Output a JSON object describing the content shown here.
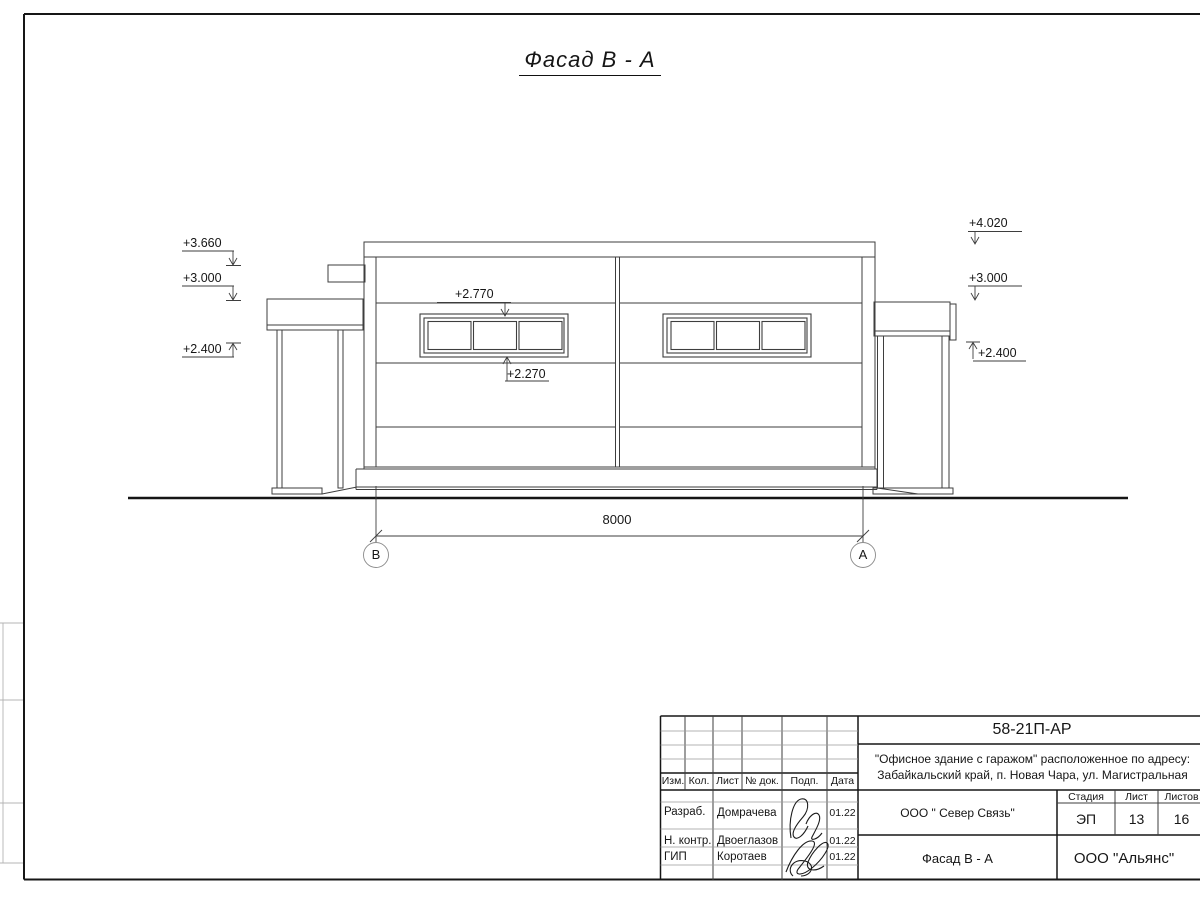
{
  "sheet": {
    "view_title": "Фасад В - А"
  },
  "drawing": {
    "marks_left": [
      "+3.660",
      "+3.000",
      "+2.400"
    ],
    "mark_window_top": "+2.770",
    "mark_window_bottom": "+2.270",
    "marks_right": [
      "+4.020",
      "+3.000",
      "+2.400"
    ],
    "dimension_total": "8000",
    "axis_left": "В",
    "axis_right": "А"
  },
  "title_block": {
    "doc_number": "58-21П-АР",
    "project_line1": "\"Офисное здание с гаражом\" расположенное по адресу:",
    "project_line2": "Забайкальский край, п. Новая Чара, ул. Магистральная",
    "col_izm": "Изм.",
    "col_kol": "Кол.",
    "col_list": "Лист",
    "col_doc": "№ док.",
    "col_podp": "Подп.",
    "col_data": "Дата",
    "rows": [
      {
        "role": "Разраб.",
        "name": "Домрачева",
        "date": "01.22"
      },
      {
        "role": "Н. контр.",
        "name": "Двоеглазов",
        "date": "01.22"
      },
      {
        "role": "ГИП",
        "name": "Коротаев",
        "date": "01.22"
      }
    ],
    "customer": "ООО \" Север Связь\"",
    "stage_label": "Стадия",
    "list_label": "Лист",
    "listov_label": "Листов",
    "stage": "ЭП",
    "sheet_number": "13",
    "sheets_total": "16",
    "view_title": "Фасад В - А",
    "organization": "ООО \"Альянс\""
  },
  "colors": {
    "line_thin": "#3e3e3e",
    "line_bold": "#161616",
    "line_faint": "#b4b4b4",
    "background": "#ffffff"
  }
}
